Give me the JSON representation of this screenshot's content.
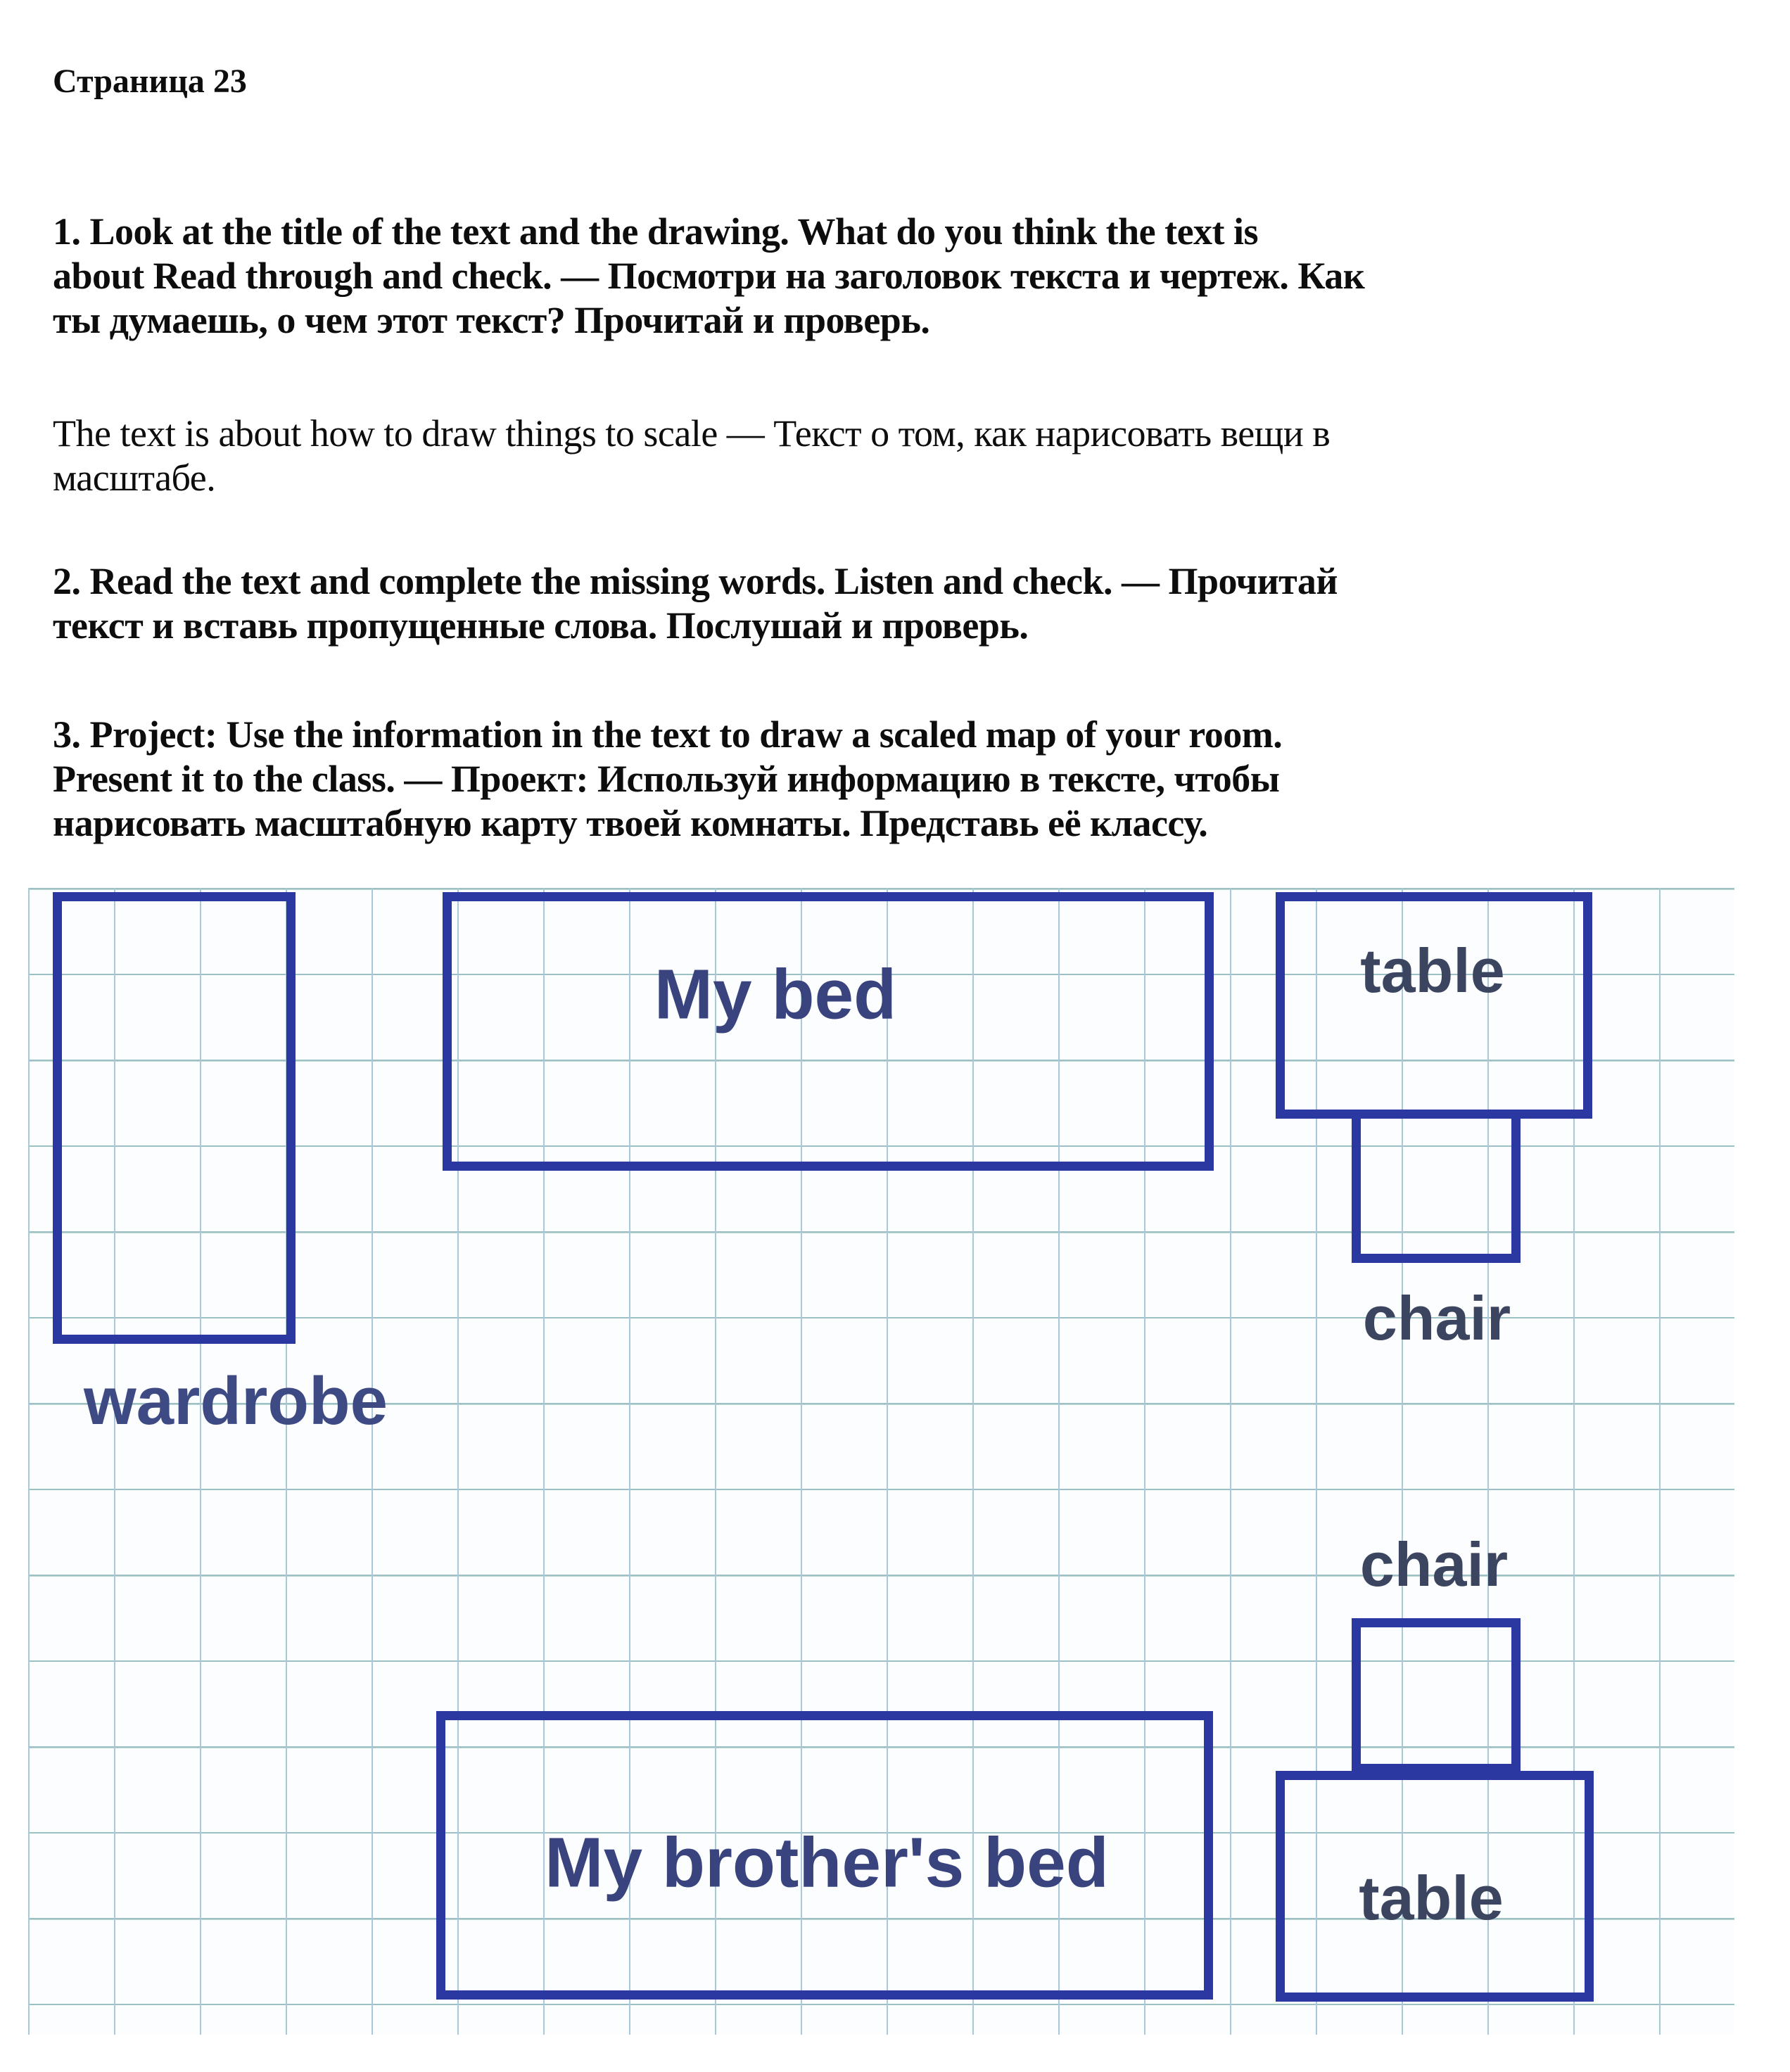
{
  "page": {
    "title": "Страница 23"
  },
  "paragraphs": {
    "p1": {
      "style": "bold",
      "lines": [
        "1. Look at the title of the text and the drawing. What do you think the text is",
        "about Read through and check. — Посмотри на заголовок текста и чертеж. Как",
        "ты думаешь, о чем этот текст? Прочитай и проверь."
      ]
    },
    "answer": {
      "style": "regular",
      "lines": [
        "The text is about how to draw things to scale — Текст о том, как нарисовать вещи в",
        "масштабе."
      ]
    },
    "p2": {
      "style": "bold",
      "lines": [
        "2. Read the text and complete the missing words. Listen and check. — Прочитай",
        "текст и вставь пропущенные слова. Послушай и проверь."
      ]
    },
    "p3": {
      "style": "bold",
      "lines": [
        "3. Project: Use the information in the text to draw a scaled map of your room.",
        "Present it to the class. — Проект: Используй информацию в тексте, чтобы",
        "нарисовать масштабную карту твоей комнаты. Представь её классу."
      ]
    }
  },
  "diagram": {
    "type": "scaled-room-map-on-grid-paper",
    "colors": {
      "outline": "#2c38a2",
      "bed_label": "#39437e",
      "small_label": "#3c4560",
      "grid_minor": "#a9c8da",
      "grid_major": "#9cc0c4",
      "paper": "#fbfdfe"
    },
    "items": {
      "wardrobe": {
        "label": "wardrobe"
      },
      "my_bed": {
        "label": "My bed"
      },
      "table_top": {
        "label": "table"
      },
      "chair_top": {
        "label": "chair"
      },
      "chair_bottom": {
        "label": "chair"
      },
      "table_bottom": {
        "label": "table"
      },
      "brothers_bed": {
        "label": "My brother's bed"
      }
    }
  }
}
